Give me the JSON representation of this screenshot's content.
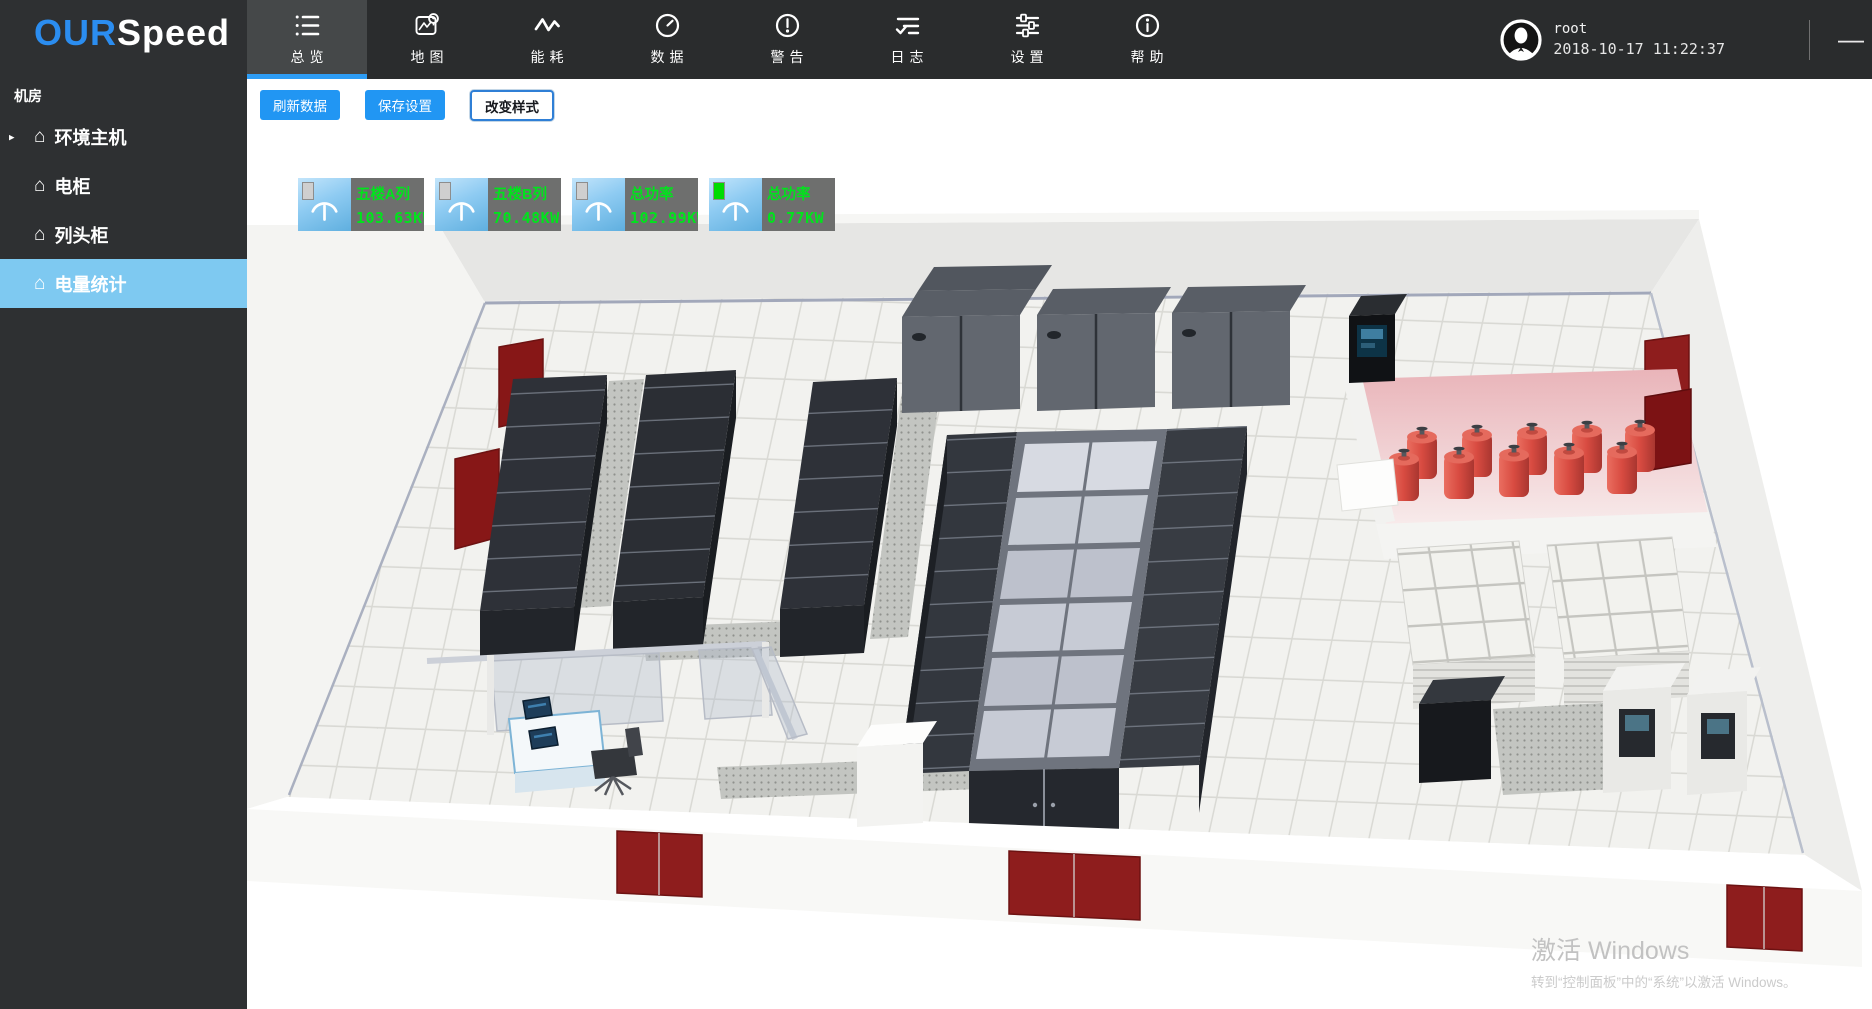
{
  "app": {
    "brand_prefix": "OUR",
    "brand_suffix": "Speed"
  },
  "sidebar": {
    "section": "机房",
    "items": [
      {
        "label": "环境主机",
        "arrow": "▸",
        "active": false
      },
      {
        "label": "电柜",
        "active": false
      },
      {
        "label": "列头柜",
        "active": false
      },
      {
        "label": "电量统计",
        "active": true
      }
    ]
  },
  "icons": {
    "home_glyph": "⌂"
  },
  "nav": {
    "tabs": [
      {
        "label": "总览",
        "icon": "list-icon",
        "active": true
      },
      {
        "label": "地图",
        "icon": "map-icon",
        "active": false
      },
      {
        "label": "能耗",
        "icon": "energy-icon",
        "active": false
      },
      {
        "label": "数据",
        "icon": "gauge-icon",
        "active": false
      },
      {
        "label": "警告",
        "icon": "alert-icon",
        "active": false
      },
      {
        "label": "日志",
        "icon": "log-icon",
        "active": false
      },
      {
        "label": "设置",
        "icon": "settings-icon",
        "active": false
      },
      {
        "label": "帮助",
        "icon": "help-icon",
        "active": false
      }
    ],
    "user": {
      "name": "root",
      "datetime": "2018-10-17 11:22:37"
    },
    "window": {
      "minimize": "—"
    }
  },
  "toolbar": {
    "refresh_label": "刷新数据",
    "save_label": "保存设置",
    "change_style_label": "改变样式"
  },
  "kpis": [
    {
      "name": "五楼A列",
      "value": "103.63KW",
      "indicator_color": "#cfcfcf"
    },
    {
      "name": "五楼B列",
      "value": "70.48KW",
      "indicator_color": "#cfcfcf"
    },
    {
      "name": "总功率",
      "value": "102.99KW",
      "indicator_color": "#cfcfcf"
    },
    {
      "name": "总功率",
      "value": "0.77KW",
      "indicator_color": "#00dc00"
    }
  ],
  "watermark": {
    "title": "激活 Windows",
    "subtitle": "转到“控制面板”中的“系统”以激活 Windows。"
  },
  "colors": {
    "accent": "#2196f3",
    "nav_active_underline": "#2e9df5",
    "sidebar_active_bg": "#7ec9f1",
    "kpi_text_green": "#00e41c",
    "door_red": "#8e1d1d",
    "cylinder_red": "#d84b41"
  }
}
